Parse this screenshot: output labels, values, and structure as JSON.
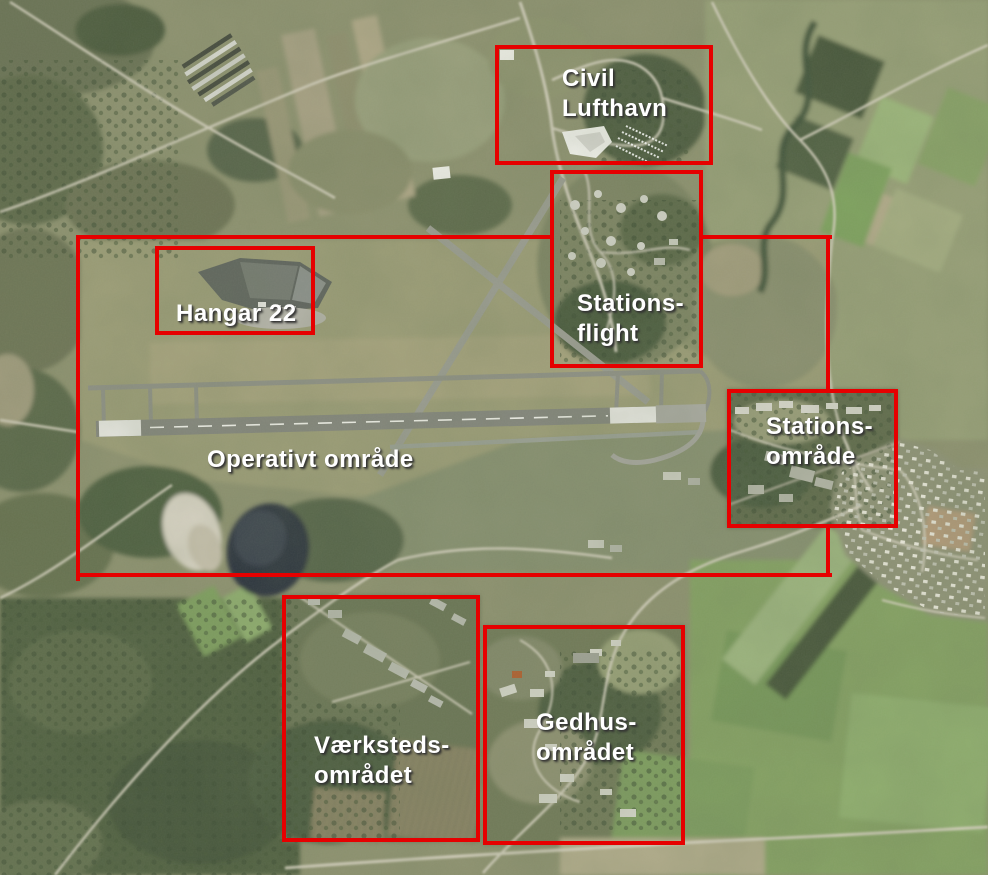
{
  "map": {
    "title": "Annotated aerial photo of airbase areas",
    "box_color": "#e60000",
    "label_color": "#ffffff",
    "regions": [
      {
        "id": "civil-lufthavn",
        "label_lines": [
          "Civil",
          "Lufthavn"
        ],
        "box": {
          "x": 495,
          "y": 45,
          "w": 218,
          "h": 120
        },
        "label_pos": {
          "x": 562,
          "y": 64
        }
      },
      {
        "id": "stationsflight",
        "label_lines": [
          "Stations-",
          "flight"
        ],
        "box": {
          "x": 550,
          "y": 170,
          "w": 153,
          "h": 198
        },
        "label_pos": {
          "x": 577,
          "y": 289
        }
      },
      {
        "id": "hangar-22",
        "label_lines": [
          "Hangar 22"
        ],
        "box": {
          "x": 155,
          "y": 246,
          "w": 160,
          "h": 89
        },
        "label_pos": {
          "x": 176,
          "y": 299
        }
      },
      {
        "id": "operativt-omraade",
        "label_lines": [
          "Operativt område"
        ],
        "box": {
          "x": 76,
          "y": 235,
          "w": 756,
          "h": 346
        },
        "label_pos": {
          "x": 207,
          "y": 445
        },
        "edge_segments": [
          {
            "x": 76,
            "y": 235,
            "w": 474,
            "h": 4
          },
          {
            "x": 703,
            "y": 235,
            "w": 129,
            "h": 4
          },
          {
            "x": 76,
            "y": 235,
            "w": 4,
            "h": 346
          },
          {
            "x": 76,
            "y": 573,
            "w": 756,
            "h": 4
          },
          {
            "x": 826,
            "y": 235,
            "w": 4,
            "h": 154
          },
          {
            "x": 826,
            "y": 528,
            "w": 4,
            "h": 49
          }
        ]
      },
      {
        "id": "stations-omraade",
        "label_lines": [
          "Stations-",
          "område"
        ],
        "box": {
          "x": 727,
          "y": 389,
          "w": 171,
          "h": 139
        },
        "label_pos": {
          "x": 766,
          "y": 412
        }
      },
      {
        "id": "vaerksteds-omraadet",
        "label_lines": [
          "Værksteds-",
          "området"
        ],
        "box": {
          "x": 282,
          "y": 595,
          "w": 198,
          "h": 247
        },
        "label_pos": {
          "x": 314,
          "y": 731
        }
      },
      {
        "id": "gedhus-omraadet",
        "label_lines": [
          "Gedhus-",
          "området"
        ],
        "box": {
          "x": 483,
          "y": 625,
          "w": 202,
          "h": 220
        },
        "label_pos": {
          "x": 536,
          "y": 708
        }
      }
    ]
  }
}
